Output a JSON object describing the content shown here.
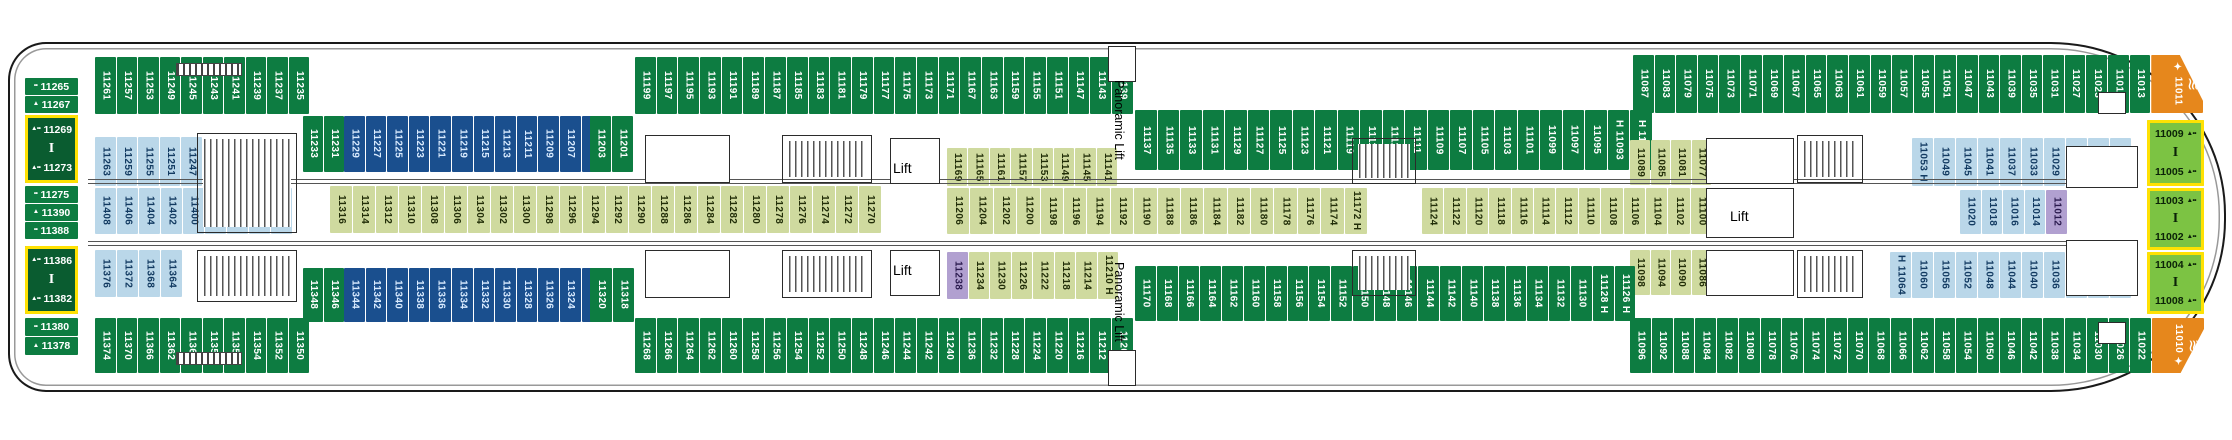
{
  "deck": {
    "ship_area": "deck-plan",
    "lift_label": "Lift",
    "panoramic_lift_label": "Panoramic Lift"
  },
  "colors": {
    "green": "#0d7c41",
    "navy": "#1a4f8e",
    "lightblue": "#bad7e9",
    "olive": "#cfda9f",
    "purple": "#b1a0d0",
    "orange": "#e6871c",
    "suite": "#0a5c30",
    "bowgreen": "#7cc343",
    "suite_border": "#ffe103"
  },
  "icons": {
    "waves": "≋",
    "connector": "I",
    "beds": "••",
    "sofa": "▲",
    "suite_mark": "▲••",
    "sparkle": "✦"
  },
  "cabin_bands": [
    {
      "name": "top-row-stern",
      "x": 95,
      "y": 57,
      "h": 57,
      "cw": 20.5,
      "color": "green",
      "cells": [
        "11261",
        "11257",
        "11253",
        "11249",
        "11245",
        "11243",
        "11241",
        "11239",
        "11237",
        "11235"
      ]
    },
    {
      "name": "row2-stern-green-a",
      "x": 303,
      "y": 116,
      "h": 56,
      "cw": 20,
      "color": "green",
      "cells": [
        "11233",
        "11231"
      ]
    },
    {
      "name": "row2-stern-navy",
      "x": 344,
      "y": 116,
      "h": 56,
      "cw": 20.6,
      "color": "navy",
      "cells": [
        "11229",
        "11227",
        "11225",
        "11223",
        "11221",
        "11219",
        "11215",
        "11213",
        "11211",
        "11209",
        "11207",
        "11205"
      ]
    },
    {
      "name": "row2-stern-green-b",
      "x": 590,
      "y": 116,
      "h": 56,
      "cw": 21,
      "color": "green",
      "cells": [
        "11203",
        "11201"
      ]
    },
    {
      "name": "top-row-mid",
      "x": 635,
      "y": 57,
      "h": 57,
      "cw": 20.7,
      "color": "green",
      "cells": [
        "11199",
        "11197",
        "11195",
        "11193",
        "11191",
        "11189",
        "11187",
        "11185",
        "11183",
        "11181",
        "11179",
        "11177",
        "11175",
        "11173",
        "11171",
        "11167",
        "11163",
        "11159",
        "11155",
        "11151",
        "11147",
        "11143",
        "11139"
      ]
    },
    {
      "name": "row2-mid",
      "x": 1135,
      "y": 110,
      "h": 60,
      "cw": 21.5,
      "color": "green",
      "cells": [
        "11137",
        "11135",
        "11133",
        "11131",
        "11129",
        "11127",
        "11125",
        "11123",
        "11121",
        "11119",
        "11115",
        "11113",
        "11111",
        "11109",
        "11107",
        "11105",
        "11103",
        "11101",
        "11099",
        "11097",
        "11095",
        "H 11093",
        "H 11091"
      ]
    },
    {
      "name": "top-row-bow",
      "x": 1633,
      "y": 55,
      "h": 58,
      "cw": 20.6,
      "color": "green",
      "cells": [
        "11087",
        "11083",
        "11079",
        "11075",
        "11073",
        "11071",
        "11069",
        "11067",
        "11065",
        "11063",
        "11061",
        "11059",
        "11057",
        "11055",
        "11051",
        "11047",
        "11043",
        "11039",
        "11035",
        "11031",
        "11027",
        "11023",
        "11019",
        "11013",
        {
          "t": "✦ 11011",
          "c": "orange",
          "w": 52,
          "icon": "waves",
          "clip": "bowtop"
        }
      ]
    },
    {
      "name": "inner-upper-stern",
      "x": 95,
      "y": 137,
      "h": 49,
      "cw": 20.5,
      "color": "lightblue",
      "cells": [
        "11263",
        "11259",
        "11255",
        "11251",
        "11247"
      ]
    },
    {
      "name": "inner-upper-mid",
      "x": 947,
      "y": 148,
      "h": 38,
      "cw": 20.4,
      "color": "olive",
      "cells": [
        "11169",
        "11165",
        "11161",
        "11157",
        "11153",
        "11149",
        "11145",
        "11141"
      ]
    },
    {
      "name": "inner-upper-right",
      "x": 1630,
      "y": 140,
      "h": 45,
      "cw": 19.5,
      "color": "olive",
      "cells": [
        "11089",
        "11085",
        "11081",
        "11077"
      ]
    },
    {
      "name": "inner-upper-bow",
      "x": 1912,
      "y": 138,
      "h": 48,
      "cw": 21,
      "color": "lightblue",
      "cells": [
        "11053 H",
        "11049",
        "11045",
        "11041",
        "11037",
        "11033",
        "11029",
        "11025",
        "11021",
        "11015"
      ]
    },
    {
      "name": "center-row-stern",
      "x": 95,
      "y": 188,
      "h": 46,
      "cw": 21,
      "color": "lightblue",
      "cells": [
        "11408",
        "11406",
        "11404",
        "11402",
        "11400",
        "11398",
        "11396",
        "11394",
        "11392"
      ]
    },
    {
      "name": "center-row-left",
      "x": 330,
      "y": 186,
      "h": 47,
      "cw": 22,
      "color": "olive",
      "cells": [
        "11316",
        "11314",
        "11312",
        "11310",
        "11308",
        "11306",
        "11304",
        "11302",
        "11300",
        "11298",
        "11296",
        "11294",
        "11292",
        "11290",
        "11288",
        "11286",
        "11284",
        "11282",
        "11280",
        "11278",
        "11276",
        "11274",
        "11272",
        "11270"
      ]
    },
    {
      "name": "center-row-mid",
      "x": 947,
      "y": 188,
      "h": 46,
      "cw": 22.4,
      "color": "olive",
      "cells": [
        "11206",
        "11204",
        "11202",
        "11200",
        "11198",
        "11196",
        "11194",
        "11192",
        "11190",
        "11188",
        "11186",
        "11184",
        "11182",
        "11180",
        "11178",
        "11176",
        "11174",
        "11172 H"
      ]
    },
    {
      "name": "center-row-right",
      "x": 1422,
      "y": 188,
      "h": 46,
      "cw": 21.4,
      "color": "olive",
      "cells": [
        "11124",
        "11122",
        "11120",
        "11118",
        "11116",
        "11114",
        "11112",
        "11110",
        "11108",
        "11106",
        "11104",
        "11102",
        "11100"
      ]
    },
    {
      "name": "inner-sub-bow",
      "x": 1960,
      "y": 190,
      "h": 44,
      "cw": 20.5,
      "color": "lightblue",
      "cells": [
        "11020",
        "11018",
        "11016",
        "11014",
        {
          "t": "11012",
          "c": "purple"
        }
      ]
    },
    {
      "name": "inner-lower-stern",
      "x": 95,
      "y": 250,
      "h": 47,
      "cw": 21,
      "color": "lightblue",
      "cells": [
        "11376",
        "11372",
        "11368",
        "11364"
      ]
    },
    {
      "name": "inner-lower-mid",
      "x": 947,
      "y": 252,
      "h": 47,
      "cw": 20.5,
      "color": "olive",
      "cells": [
        {
          "t": "11238",
          "c": "purple"
        },
        "11234",
        "11230",
        "11226",
        "11222",
        "11218",
        "11214",
        "11210 H"
      ]
    },
    {
      "name": "inner-lower-right",
      "x": 1630,
      "y": 250,
      "h": 45,
      "cw": 19.5,
      "color": "olive",
      "cells": [
        "11098",
        "11094",
        "11090",
        "11086"
      ]
    },
    {
      "name": "inner-lower-bow",
      "x": 1890,
      "y": 252,
      "h": 46,
      "cw": 21,
      "color": "lightblue",
      "cells": [
        "H 11064",
        "11060",
        "11056",
        "11052",
        "11048",
        "11044",
        "11040",
        "11036",
        "11032",
        "11028",
        "11024"
      ]
    },
    {
      "name": "bottom-inner-green-a",
      "x": 303,
      "y": 268,
      "h": 54,
      "cw": 20,
      "color": "green",
      "cells": [
        "11348",
        "11346"
      ]
    },
    {
      "name": "bottom-inner-navy",
      "x": 344,
      "y": 268,
      "h": 54,
      "cw": 20.6,
      "color": "navy",
      "cells": [
        "11344",
        "11342",
        "11340",
        "11338",
        "11336",
        "11334",
        "11332",
        "11330",
        "11328",
        "11326",
        "11324",
        "11322"
      ]
    },
    {
      "name": "bottom-inner-green-b",
      "x": 590,
      "y": 268,
      "h": 54,
      "cw": 21.5,
      "color": "green",
      "cells": [
        "11320",
        "11318"
      ]
    },
    {
      "name": "bottom-row-stern",
      "x": 95,
      "y": 318,
      "h": 55,
      "cw": 20.5,
      "color": "green",
      "cells": [
        "11374",
        "11370",
        "11366",
        "11362",
        "11360",
        "11358",
        "11356",
        "11354",
        "11352",
        "11350"
      ]
    },
    {
      "name": "bottom-row-mid",
      "x": 635,
      "y": 318,
      "h": 55,
      "cw": 20.7,
      "color": "green",
      "cells": [
        "11268",
        "11266",
        "11264",
        "11262",
        "11260",
        "11258",
        "11256",
        "11254",
        "11252",
        "11250",
        "11248",
        "11246",
        "11244",
        "11242",
        "11240",
        "11236",
        "11232",
        "11228",
        "11224",
        "11220",
        "11216",
        "11212",
        "11208"
      ]
    },
    {
      "name": "bottom-row-mid2",
      "x": 1135,
      "y": 266,
      "h": 55,
      "cw": 20.8,
      "color": "green",
      "cells": [
        "11170",
        "11168",
        "11166",
        "11164",
        "11162",
        "11160",
        "11158",
        "11156",
        "11154",
        "11152",
        "11150",
        "11148",
        "11146",
        "11144",
        "11142",
        "11140",
        "11138",
        "11136",
        "11134",
        "11132",
        "11130",
        "11128 H",
        "11126 H"
      ]
    },
    {
      "name": "bottom-row-bow",
      "x": 1630,
      "y": 318,
      "h": 55,
      "cw": 20.75,
      "color": "green",
      "cells": [
        "11096",
        "11092",
        "11088",
        "11084",
        "11082",
        "11080",
        "11078",
        "11076",
        "11074",
        "11072",
        "11070",
        "11068",
        "11066",
        "11062",
        "11058",
        "11054",
        "11050",
        "11046",
        "11042",
        "11038",
        "11034",
        "11030",
        "11026",
        "11022",
        {
          "t": "11010 ✦",
          "c": "orange",
          "w": 52,
          "icon": "waves",
          "clip": "bowbottom"
        }
      ]
    }
  ],
  "stack_cells": [
    {
      "x": 25,
      "y": 78,
      "w": 53,
      "h": 17,
      "c": "green",
      "t": "11265",
      "m": "••"
    },
    {
      "x": 25,
      "y": 96,
      "w": 53,
      "h": 17,
      "c": "green",
      "t": "11267",
      "m": "▲"
    },
    {
      "x": 25,
      "y": 115,
      "w": 53,
      "h": 68,
      "c": "suite",
      "cells": [
        "11269",
        "11273"
      ],
      "m": "▲••"
    },
    {
      "x": 25,
      "y": 186,
      "w": 53,
      "h": 17,
      "c": "green",
      "t": "11275",
      "m": "••"
    },
    {
      "x": 25,
      "y": 204,
      "w": 53,
      "h": 17,
      "c": "green",
      "t": "11390",
      "m": "▲"
    },
    {
      "x": 25,
      "y": 222,
      "w": 53,
      "h": 17,
      "c": "green",
      "t": "11388",
      "m": "••"
    },
    {
      "x": 25,
      "y": 246,
      "w": 53,
      "h": 68,
      "c": "suite",
      "cells": [
        "11386",
        "11382"
      ],
      "m": "▲••"
    },
    {
      "x": 25,
      "y": 318,
      "w": 53,
      "h": 18,
      "c": "green",
      "t": "11380",
      "m": "••"
    },
    {
      "x": 25,
      "y": 337,
      "w": 53,
      "h": 18,
      "c": "green",
      "t": "11378",
      "m": "▲"
    },
    {
      "x": 2147,
      "y": 120,
      "w": 57,
      "h": 66,
      "c": "bowgreen",
      "cells": [
        "11009",
        "11005"
      ],
      "m": "▲••",
      "mr": true
    },
    {
      "x": 2147,
      "y": 188,
      "w": 57,
      "h": 62,
      "c": "bowgreen",
      "cells": [
        "11003",
        "11002"
      ],
      "m": "▲••",
      "mr": true
    },
    {
      "x": 2147,
      "y": 252,
      "w": 57,
      "h": 62,
      "c": "bowgreen",
      "cells": [
        "11004",
        "11008"
      ],
      "m": "▲••",
      "mr": true
    }
  ],
  "labels": [
    {
      "t": "Lift",
      "x": 893,
      "y": 160,
      "v": false
    },
    {
      "t": "Lift",
      "x": 893,
      "y": 262,
      "v": false
    },
    {
      "t": "Lift",
      "x": 1730,
      "y": 208,
      "v": false
    },
    {
      "t": "Panoramic Lift",
      "x": 1112,
      "y": 80,
      "v": true
    },
    {
      "t": "Panoramic Lift",
      "x": 1112,
      "y": 262,
      "v": true
    }
  ],
  "corridors": [
    {
      "x": 88,
      "y": 179,
      "w": 2040
    },
    {
      "x": 88,
      "y": 241,
      "w": 2040
    }
  ],
  "structures": [
    {
      "x": 197,
      "y": 133,
      "w": 100,
      "h": 100,
      "kind": "stairs"
    },
    {
      "x": 197,
      "y": 250,
      "w": 100,
      "h": 52,
      "kind": "stairs"
    },
    {
      "x": 176,
      "y": 63,
      "w": 66,
      "h": 13,
      "kind": "hatch"
    },
    {
      "x": 176,
      "y": 352,
      "w": 66,
      "h": 13,
      "kind": "hatch"
    },
    {
      "x": 645,
      "y": 135,
      "w": 85,
      "h": 48,
      "kind": "room"
    },
    {
      "x": 645,
      "y": 250,
      "w": 85,
      "h": 48,
      "kind": "room"
    },
    {
      "x": 782,
      "y": 135,
      "w": 90,
      "h": 48,
      "kind": "stairs"
    },
    {
      "x": 782,
      "y": 250,
      "w": 90,
      "h": 48,
      "kind": "stairs"
    },
    {
      "x": 890,
      "y": 138,
      "w": 50,
      "h": 46,
      "kind": "lift"
    },
    {
      "x": 890,
      "y": 250,
      "w": 50,
      "h": 46,
      "kind": "lift"
    },
    {
      "x": 1352,
      "y": 138,
      "w": 64,
      "h": 46,
      "kind": "stairs"
    },
    {
      "x": 1352,
      "y": 250,
      "w": 64,
      "h": 46,
      "kind": "stairs"
    },
    {
      "x": 1706,
      "y": 138,
      "w": 88,
      "h": 46,
      "kind": "lift"
    },
    {
      "x": 1706,
      "y": 188,
      "w": 88,
      "h": 50,
      "kind": "room"
    },
    {
      "x": 1706,
      "y": 250,
      "w": 88,
      "h": 46,
      "kind": "lift"
    },
    {
      "x": 1797,
      "y": 135,
      "w": 66,
      "h": 48,
      "kind": "stairs"
    },
    {
      "x": 1797,
      "y": 250,
      "w": 66,
      "h": 48,
      "kind": "stairs"
    },
    {
      "x": 2066,
      "y": 146,
      "w": 72,
      "h": 42,
      "kind": "room"
    },
    {
      "x": 2066,
      "y": 240,
      "w": 72,
      "h": 56,
      "kind": "room"
    },
    {
      "x": 1108,
      "y": 46,
      "w": 28,
      "h": 36,
      "kind": "room"
    },
    {
      "x": 1108,
      "y": 350,
      "w": 28,
      "h": 36,
      "kind": "room"
    },
    {
      "x": 2098,
      "y": 92,
      "w": 28,
      "h": 22,
      "kind": "room"
    },
    {
      "x": 2098,
      "y": 322,
      "w": 28,
      "h": 22,
      "kind": "room"
    }
  ]
}
